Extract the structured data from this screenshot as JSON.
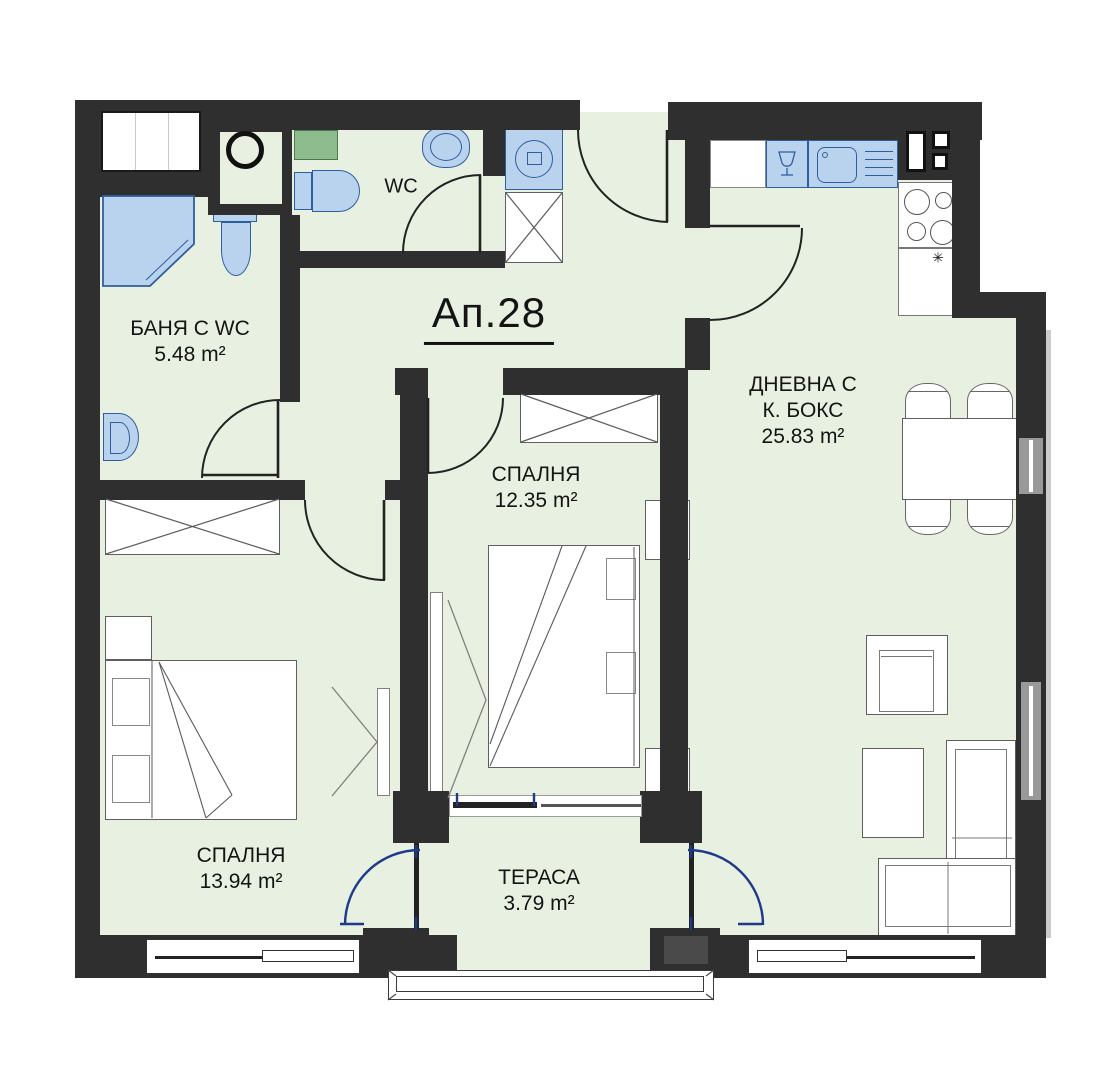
{
  "title": {
    "apartment_label": "Ап.28"
  },
  "rooms": {
    "bathroom": {
      "name": "БАНЯ С WC",
      "area": "5.48 m²"
    },
    "wc": {
      "name": "WC"
    },
    "bedroom_middle": {
      "name": "СПАЛНЯ",
      "area": "12.35 m²"
    },
    "bedroom_left": {
      "name": "СПАЛНЯ",
      "area": "13.94 m²"
    },
    "living": {
      "name_line1": "ДНЕВНА С",
      "name_line2": "К. БОКС",
      "area": "25.83 m²"
    },
    "terrace": {
      "name": "ТЕРАСА",
      "area": "3.79 m²"
    }
  },
  "fixtures": {
    "kitchen_counter_mark": "✳"
  },
  "colors": {
    "wall": "#2f2f2f",
    "floor": "#e8f0e1",
    "fixture": "#b9d3ee",
    "fixture_border": "#2f5e9e",
    "shelf": "#8fbc8f",
    "shelf_border": "#4a7a4a",
    "arc_blue": "#1e3a8a"
  }
}
